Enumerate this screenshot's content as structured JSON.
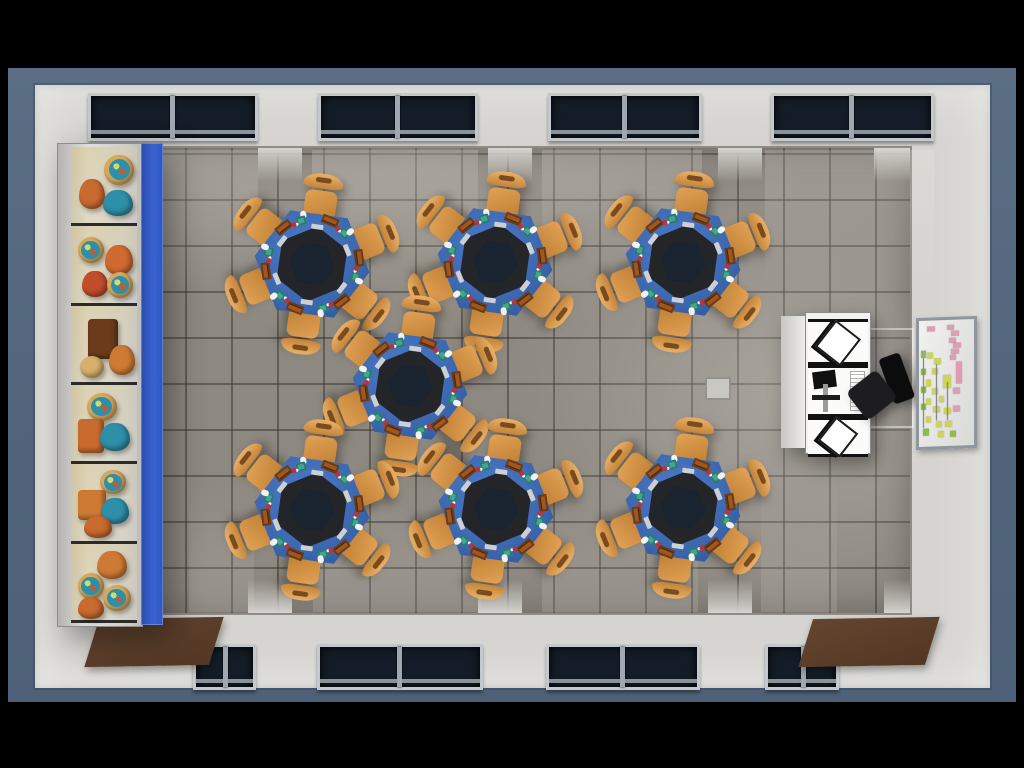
{
  "scene": {
    "name": "computer-classroom-top-down-3d-render",
    "view": "top-down"
  },
  "palette": {
    "letterbox": "#000000",
    "margin_slate": "#54687e",
    "wall": "#d6d4d0",
    "floor": "#8d8880",
    "floor_grid": "#34302a",
    "window_glass": "#141d27",
    "window_frame": "#c3c8cc",
    "table_top_blue": "#3c67b0",
    "monitor_ring": "#232528",
    "monitor_core": "#1a2330",
    "chair_orange": "#d9944a",
    "door_mat_brown": "#5a3d2a",
    "shelf_panel_blue": "#3059c6",
    "desk_white": "#f2f1ef",
    "office_chair_black": "#121214",
    "board_note_pink": "#e09cb4",
    "board_note_yellow": "#ccd45e",
    "board_note_green": "#8fbb4a",
    "keyboard_brown": "#a0561f",
    "mouse_white": "#f2f2f0",
    "accessory_teal": "#46a393"
  },
  "room": {
    "margin": {
      "x": 8,
      "y": 68,
      "w": 1008,
      "h": 634
    },
    "wall": {
      "x": 35,
      "y": 85,
      "w": 955,
      "h": 603
    },
    "floor": {
      "x": 95,
      "y": 148,
      "w": 815,
      "h": 465
    },
    "tile_size": 46,
    "windows_top": [
      {
        "x": 88,
        "y": 93,
        "w": 164,
        "h": 42
      },
      {
        "x": 318,
        "y": 93,
        "w": 154,
        "h": 42
      },
      {
        "x": 548,
        "y": 93,
        "w": 148,
        "h": 42
      },
      {
        "x": 771,
        "y": 93,
        "w": 157,
        "h": 42
      }
    ],
    "windows_bottom": [
      {
        "x": 193,
        "y": 644,
        "w": 57,
        "h": 40
      },
      {
        "x": 317,
        "y": 644,
        "w": 160,
        "h": 40
      },
      {
        "x": 546,
        "y": 644,
        "w": 148,
        "h": 40
      },
      {
        "x": 765,
        "y": 644,
        "w": 68,
        "h": 40
      }
    ],
    "door_mats": [
      {
        "x": 92,
        "y": 618,
        "w": 124,
        "h": 48
      },
      {
        "x": 806,
        "y": 618,
        "w": 126,
        "h": 48
      }
    ],
    "pillars_top": [
      {
        "x": 95,
        "w": 58
      },
      {
        "x": 258,
        "w": 44
      },
      {
        "x": 488,
        "w": 44
      },
      {
        "x": 718,
        "w": 44
      },
      {
        "x": 874,
        "w": 36
      }
    ],
    "pillars_bottom": [
      {
        "x": 95,
        "w": 48
      },
      {
        "x": 248,
        "w": 44
      },
      {
        "x": 478,
        "w": 44
      },
      {
        "x": 708,
        "w": 44
      },
      {
        "x": 884,
        "w": 26
      }
    ],
    "floor_outlet": {
      "x": 705,
      "y": 377,
      "w": 22,
      "h": 19
    }
  },
  "shelf": {
    "x": 57,
    "y": 143,
    "w": 106,
    "h": 482,
    "rows": 6,
    "items": [
      [
        {
          "t": "blob",
          "x": 12,
          "y": 42,
          "w": 26,
          "h": 30,
          "c": "#c96a2e"
        },
        {
          "t": "globe",
          "x": 50,
          "y": 10,
          "w": 30,
          "h": 30
        },
        {
          "t": "blob",
          "x": 48,
          "y": 56,
          "w": 30,
          "h": 26,
          "c": "#2e8fa8"
        }
      ],
      [
        {
          "t": "globe",
          "x": 10,
          "y": 14,
          "w": 26,
          "h": 26
        },
        {
          "t": "blob",
          "x": 52,
          "y": 24,
          "w": 28,
          "h": 30,
          "c": "#d06a30"
        },
        {
          "t": "blob",
          "x": 16,
          "y": 58,
          "w": 26,
          "h": 26,
          "c": "#c14e2a"
        },
        {
          "t": "globe",
          "x": 55,
          "y": 60,
          "w": 26,
          "h": 26
        }
      ],
      [
        {
          "t": "sbox",
          "x": 26,
          "y": 18,
          "w": 30,
          "h": 40,
          "c": "#6b3b1c"
        },
        {
          "t": "blob",
          "x": 58,
          "y": 52,
          "w": 26,
          "h": 30,
          "c": "#cf7a34"
        },
        {
          "t": "disc",
          "x": 14,
          "y": 66,
          "w": 24,
          "h": 22
        }
      ],
      [
        {
          "t": "globe",
          "x": 24,
          "y": 10,
          "w": 30,
          "h": 28
        },
        {
          "t": "sbox",
          "x": 10,
          "y": 44,
          "w": 26,
          "h": 34,
          "c": "#c96a2e"
        },
        {
          "t": "blob",
          "x": 44,
          "y": 50,
          "w": 30,
          "h": 28,
          "c": "#2e8fa8"
        }
      ],
      [
        {
          "t": "globe",
          "x": 44,
          "y": 8,
          "w": 26,
          "h": 24
        },
        {
          "t": "sbox",
          "x": 10,
          "y": 34,
          "w": 28,
          "h": 30,
          "c": "#cf7a34"
        },
        {
          "t": "blob",
          "x": 46,
          "y": 44,
          "w": 28,
          "h": 26,
          "c": "#2e8fa8"
        },
        {
          "t": "blob",
          "x": 20,
          "y": 68,
          "w": 28,
          "h": 22,
          "c": "#c96a2e"
        }
      ],
      [
        {
          "t": "blob",
          "x": 40,
          "y": 10,
          "w": 30,
          "h": 28,
          "c": "#cf7a34"
        },
        {
          "t": "globe",
          "x": 10,
          "y": 38,
          "w": 26,
          "h": 26
        },
        {
          "t": "globe",
          "x": 48,
          "y": 54,
          "w": 28,
          "h": 26
        },
        {
          "t": "blob",
          "x": 10,
          "y": 70,
          "w": 26,
          "h": 22,
          "c": "#c96a2e"
        }
      ]
    ]
  },
  "tables": {
    "count": 7,
    "seats_per_table": 6,
    "rotation_deg": 8,
    "positions": [
      {
        "x": 312,
        "y": 264
      },
      {
        "x": 495,
        "y": 262
      },
      {
        "x": 683,
        "y": 262
      },
      {
        "x": 410,
        "y": 386
      },
      {
        "x": 312,
        "y": 510
      },
      {
        "x": 496,
        "y": 509
      },
      {
        "x": 683,
        "y": 508
      }
    ]
  },
  "teacher_station": {
    "x": 781,
    "y": 312,
    "w": 90,
    "h": 140,
    "panels": 3,
    "has_monitor": true,
    "has_black_chair": true
  },
  "board": {
    "x": 916,
    "y": 317,
    "w": 55,
    "h": 126,
    "notes": [
      {
        "c": "pink",
        "x": 14,
        "y": 5,
        "w": 16,
        "h": 4
      },
      {
        "c": "pink",
        "x": 50,
        "y": 4,
        "w": 14,
        "h": 4
      },
      {
        "c": "pink",
        "x": 58,
        "y": 9,
        "w": 14,
        "h": 4
      },
      {
        "c": "pink",
        "x": 54,
        "y": 14,
        "w": 14,
        "h": 4
      },
      {
        "c": "pink",
        "x": 62,
        "y": 18,
        "w": 14,
        "h": 4
      },
      {
        "c": "pink",
        "x": 58,
        "y": 23,
        "w": 14,
        "h": 4
      },
      {
        "c": "pink",
        "x": 56,
        "y": 28,
        "w": 12,
        "h": 4
      },
      {
        "c": "green",
        "x": 4,
        "y": 24,
        "w": 8,
        "h": 5
      },
      {
        "c": "yellow",
        "x": 14,
        "y": 25,
        "w": 12,
        "h": 5
      },
      {
        "c": "yellow",
        "x": 28,
        "y": 30,
        "w": 12,
        "h": 5
      },
      {
        "c": "pink",
        "x": 68,
        "y": 33,
        "w": 10,
        "h": 18
      },
      {
        "c": "yellow",
        "x": 24,
        "y": 38,
        "w": 10,
        "h": 5
      },
      {
        "c": "green",
        "x": 4,
        "y": 38,
        "w": 8,
        "h": 5
      },
      {
        "c": "yellow",
        "x": 44,
        "y": 44,
        "w": 14,
        "h": 10
      },
      {
        "c": "yellow",
        "x": 12,
        "y": 47,
        "w": 10,
        "h": 5
      },
      {
        "c": "pink",
        "x": 62,
        "y": 54,
        "w": 12,
        "h": 5
      },
      {
        "c": "yellow",
        "x": 24,
        "y": 54,
        "w": 10,
        "h": 5
      },
      {
        "c": "green",
        "x": 4,
        "y": 52,
        "w": 8,
        "h": 5
      },
      {
        "c": "yellow",
        "x": 36,
        "y": 60,
        "w": 10,
        "h": 5
      },
      {
        "c": "yellow",
        "x": 12,
        "y": 62,
        "w": 10,
        "h": 5
      },
      {
        "c": "green",
        "x": 4,
        "y": 66,
        "w": 8,
        "h": 5
      },
      {
        "c": "yellow",
        "x": 26,
        "y": 68,
        "w": 12,
        "h": 5
      },
      {
        "c": "yellow",
        "x": 46,
        "y": 70,
        "w": 12,
        "h": 5
      },
      {
        "c": "pink",
        "x": 62,
        "y": 68,
        "w": 12,
        "h": 5
      },
      {
        "c": "yellow",
        "x": 12,
        "y": 76,
        "w": 10,
        "h": 5
      },
      {
        "c": "yellow",
        "x": 30,
        "y": 80,
        "w": 12,
        "h": 5
      },
      {
        "c": "yellow",
        "x": 48,
        "y": 80,
        "w": 12,
        "h": 5
      },
      {
        "c": "green",
        "x": 8,
        "y": 86,
        "w": 10,
        "h": 5
      },
      {
        "c": "yellow",
        "x": 34,
        "y": 88,
        "w": 12,
        "h": 5
      },
      {
        "c": "green",
        "x": 56,
        "y": 88,
        "w": 12,
        "h": 5
      },
      {
        "c": "line",
        "x": 8,
        "y": 29,
        "w": 2,
        "h": 56
      },
      {
        "c": "line",
        "x": 30,
        "y": 35,
        "w": 2,
        "h": 44
      },
      {
        "c": "line",
        "x": 50,
        "y": 49,
        "w": 2,
        "h": 30
      }
    ]
  }
}
